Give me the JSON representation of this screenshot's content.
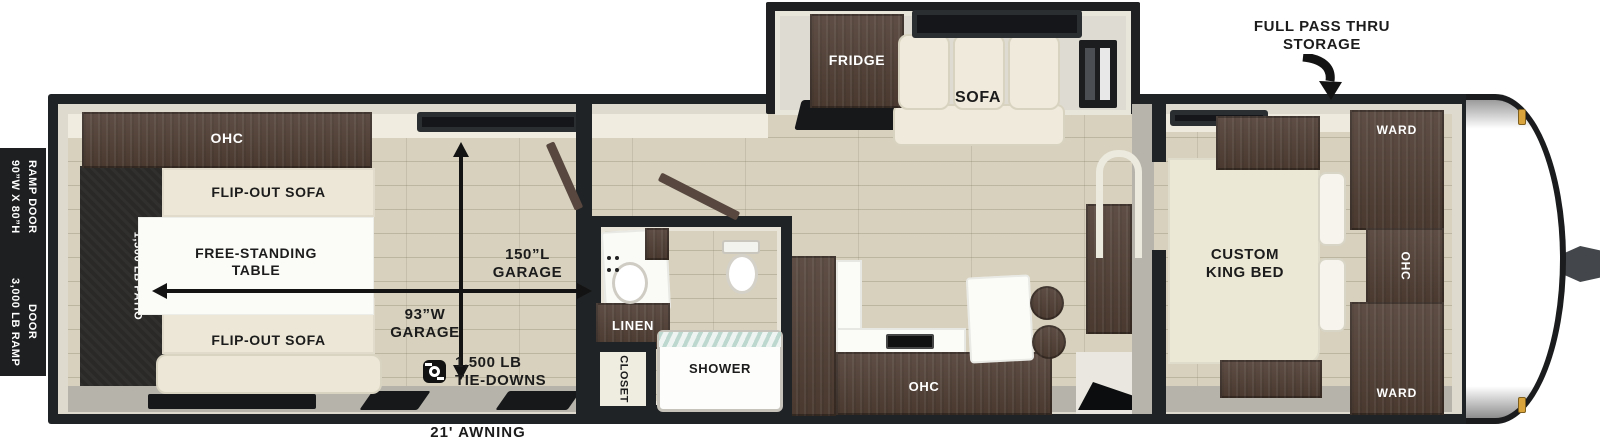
{
  "exterior": {
    "ramp_door_size_line1": "90”W X 80”H",
    "ramp_door_size_line2": "RAMP DOOR",
    "ramp_door_capacity_line1": "3,000 LB RAMP",
    "ramp_door_capacity_line2": "DOOR",
    "pass_thru_line1": "FULL PASS THRU",
    "pass_thru_line2": "STORAGE",
    "awning_label": "21' AWNING"
  },
  "garage": {
    "ohc_label": "OHC",
    "flip_out_sofa_top_label": "FLIP-OUT SOFA",
    "flip_out_sofa_bottom_label": "FLIP-OUT SOFA",
    "table_line1": "FREE-STANDING",
    "table_line2": "TABLE",
    "patio_label": "1,500 LB PATIO",
    "length_line1": "150”L",
    "length_line2": "GARAGE",
    "width_line1": "93”W",
    "width_line2": "GARAGE",
    "tie_downs_line1": "1,500 LB",
    "tie_downs_line2": "TIE-DOWNS"
  },
  "bathroom": {
    "linen_label": "LINEN",
    "closet_label": "CLOSET",
    "shower_label": "SHOWER"
  },
  "kitchen": {
    "ohc_label": "OHC"
  },
  "slideout": {
    "fridge_label": "FRIDGE",
    "sofa_label": "SOFA"
  },
  "bedroom": {
    "bed_line1": "CUSTOM",
    "bed_line2": "KING BED",
    "ward_top_label": "WARD",
    "ward_bottom_label": "WARD",
    "ohc_label": "OHC"
  },
  "colors": {
    "wall": "#202325",
    "floor": "#d7d1be",
    "cabinet": "#52423a",
    "upholstery": "#ece7d6",
    "patio": "#2a2927",
    "marker_light": "#d9a43b",
    "label": "#1c1c1c",
    "trim": "#dedbce"
  }
}
